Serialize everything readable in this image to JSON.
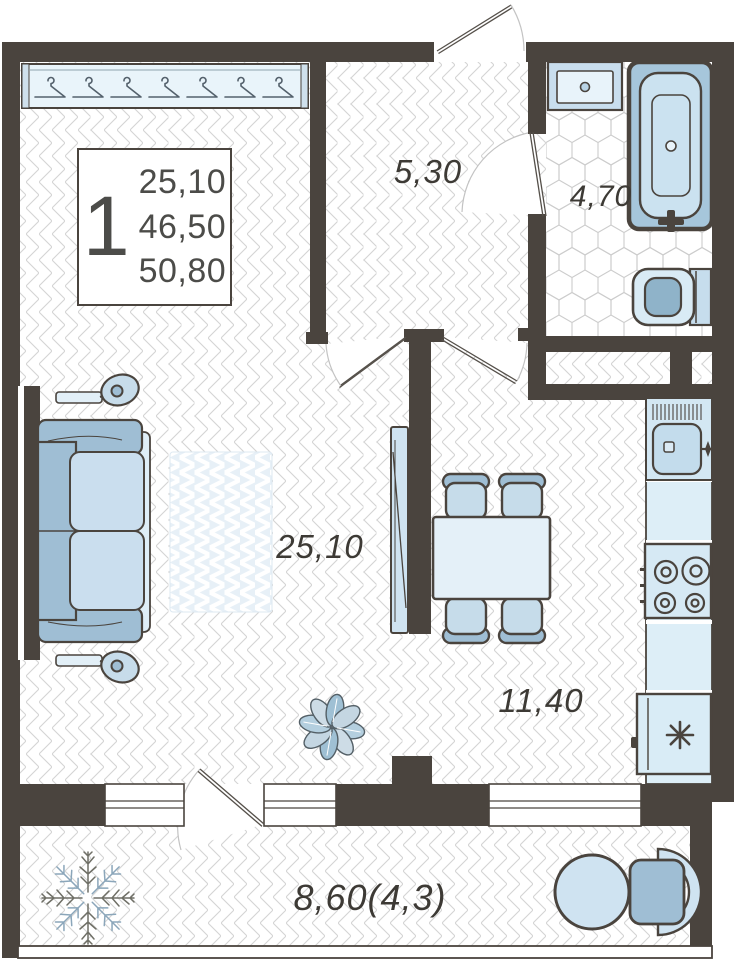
{
  "unit_card": {
    "rooms_count": "1",
    "room_area": "25,10",
    "living_area": "46,50",
    "total_area": "50,80"
  },
  "room_labels": {
    "hallway": "5,30",
    "bathroom": "4,70",
    "living_room": "25,10",
    "kitchen": "11,40",
    "balcony": "8,60(4,3)"
  },
  "colors": {
    "wall": "#4a443e",
    "furniture_outline": "#4a443e",
    "blue_light": "#cfe3f1",
    "blue_mid": "#9fbed4",
    "blue_pale": "#e8f3fa",
    "floor_line": "#d2d2d2",
    "label_text": "#3d3a35"
  }
}
